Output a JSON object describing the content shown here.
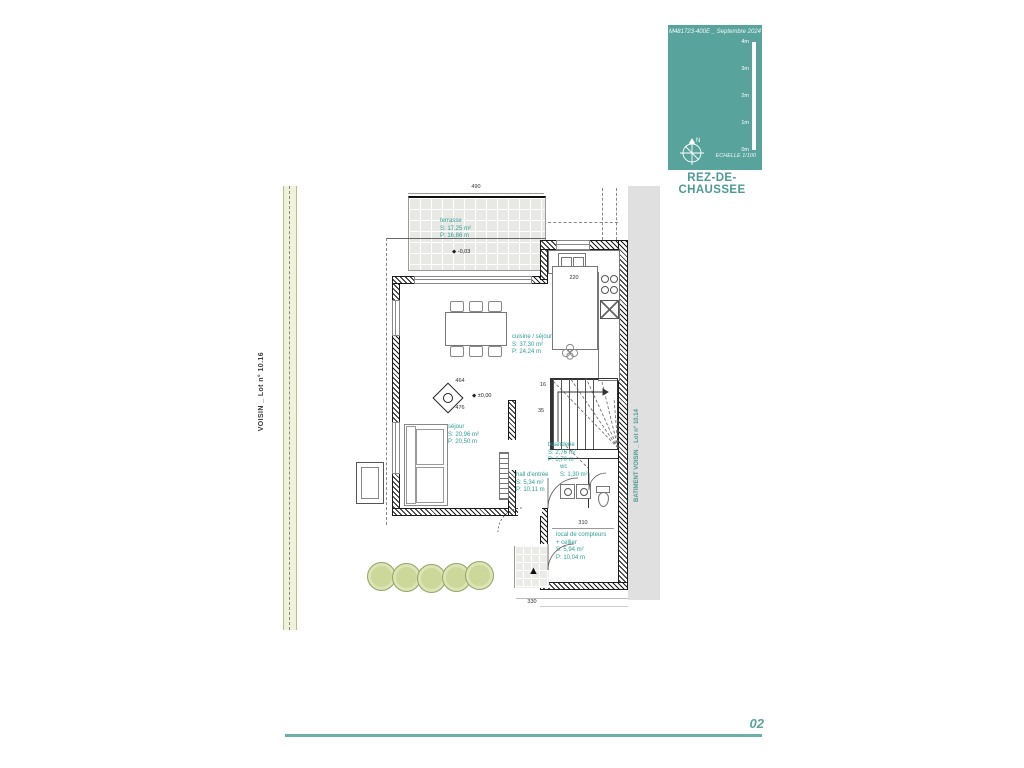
{
  "title_block": {
    "ref": "M481723-400E _ Septembre 2024",
    "scale_ticks": [
      "4m",
      "3m",
      "2m",
      "1m",
      "0m"
    ],
    "scale_label": "ECHELLE 1/100",
    "north": "N",
    "drawing_title": "REZ-DE-CHAUSSEE",
    "teal": "#58a39c"
  },
  "page": {
    "number": "02"
  },
  "site": {
    "left_neighbor": "VOISIN _ Lot n° 10.16",
    "right_neighbor_line1": "BATIMENT VOISIN _",
    "right_neighbor_line2": "Lot n° 10.14"
  },
  "rooms": {
    "terrasse": {
      "name": "terrasse",
      "s": "S: 17,25 m²",
      "p": "P: 16,86 m"
    },
    "cuisine_sejour": {
      "name": "cuisine / séjour",
      "s": "S: 37,30 m²",
      "p": "P: 24,24 m"
    },
    "sejour": {
      "name": "séjour",
      "s": "S: 20,96 m²",
      "p": "P: 20,50 m"
    },
    "buanderie": {
      "name": "buanderie",
      "s": "S: 2,76 m²",
      "p": "P: 6,70 m"
    },
    "hall": {
      "name": "hall d'entrée",
      "s": "S: 5,34 m²",
      "p": "P: 10,11 m"
    },
    "wc": {
      "name": "wc",
      "s": "S: 1,30 m²"
    },
    "local": {
      "name": "local de compteurs",
      "name2": "+ cellier",
      "s": "S: 5,94 m²",
      "p": "P: 10,04 m"
    }
  },
  "levels": {
    "terrace": "-0,03",
    "ground": "±0,00"
  },
  "dims": {
    "terrace_width": "490",
    "island": "220",
    "local_width": "310",
    "entry": "330",
    "living_a": "464",
    "living_b": "476",
    "stair_count": "16",
    "stair_b": "35"
  },
  "icons": {
    "level_diamond": "◆",
    "entrance_arrow": "▲"
  }
}
